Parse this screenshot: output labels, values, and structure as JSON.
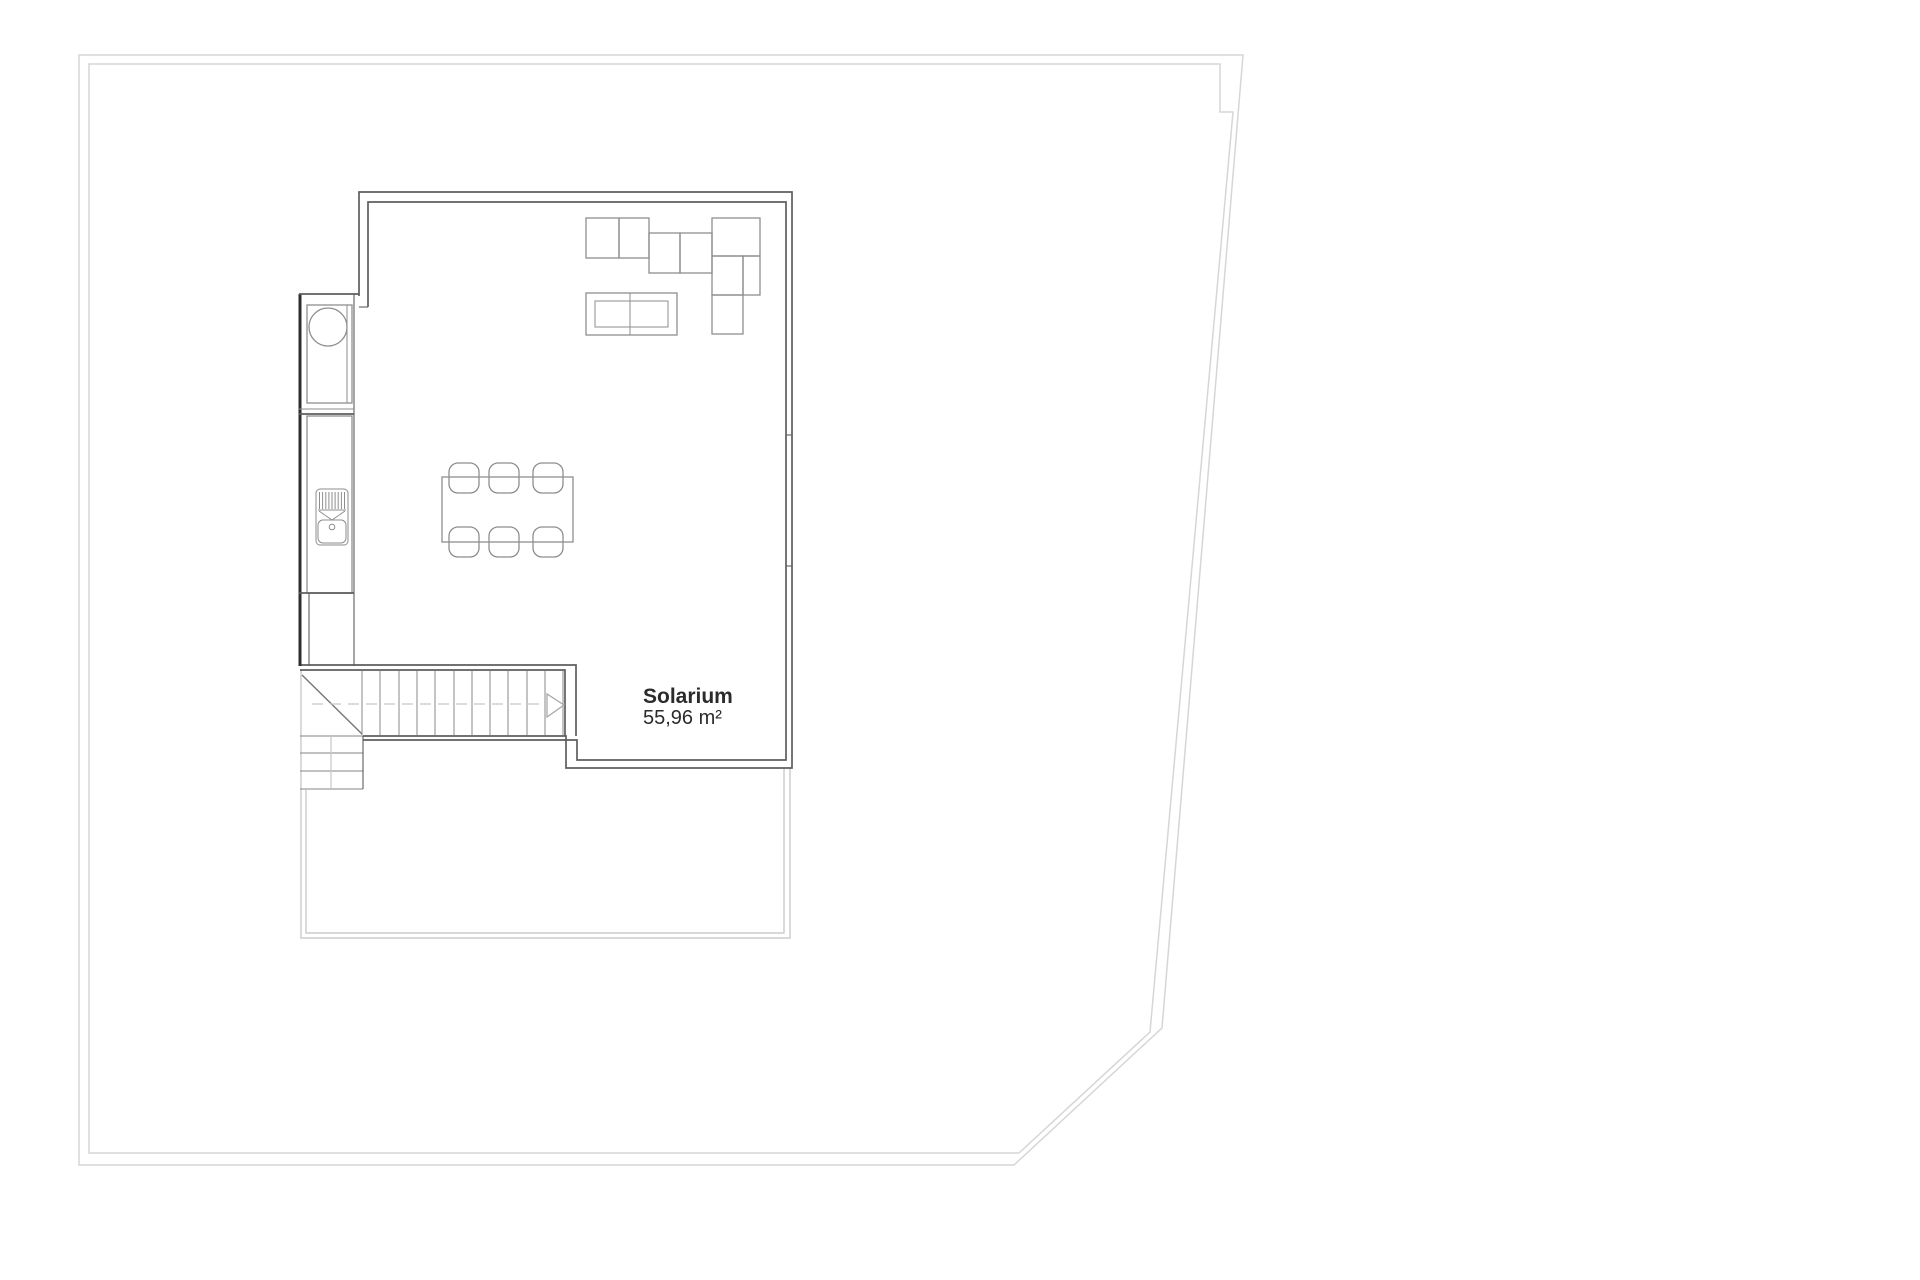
{
  "floorplan": {
    "room": {
      "name": "Solarium",
      "area": "55,96 m²"
    },
    "colors": {
      "background": "#ffffff",
      "property_boundary": "#d5d6d8",
      "wall": "#5e5e5e",
      "wall_dark": "#2e2e2e",
      "furniture": "#8e8e8e",
      "stair": "#9c9c9c",
      "stair_diagonal": "#7a7a7a",
      "centerline": "#c6c6c6",
      "arrow": "#a9a9a9",
      "terrace": "#c9cbcd",
      "label_text": "#2b2b2b"
    },
    "icons": [
      {
        "name": "round-basin-icon"
      },
      {
        "name": "sink-grill-icon"
      },
      {
        "name": "stair-direction-arrow-icon"
      }
    ],
    "furniture_inventory": [
      "sectional-sofa (8 modules)",
      "coffee-table",
      "dining-table",
      "dining-chairs (6)",
      "kitchen-counter (2 units)",
      "staircase"
    ]
  }
}
